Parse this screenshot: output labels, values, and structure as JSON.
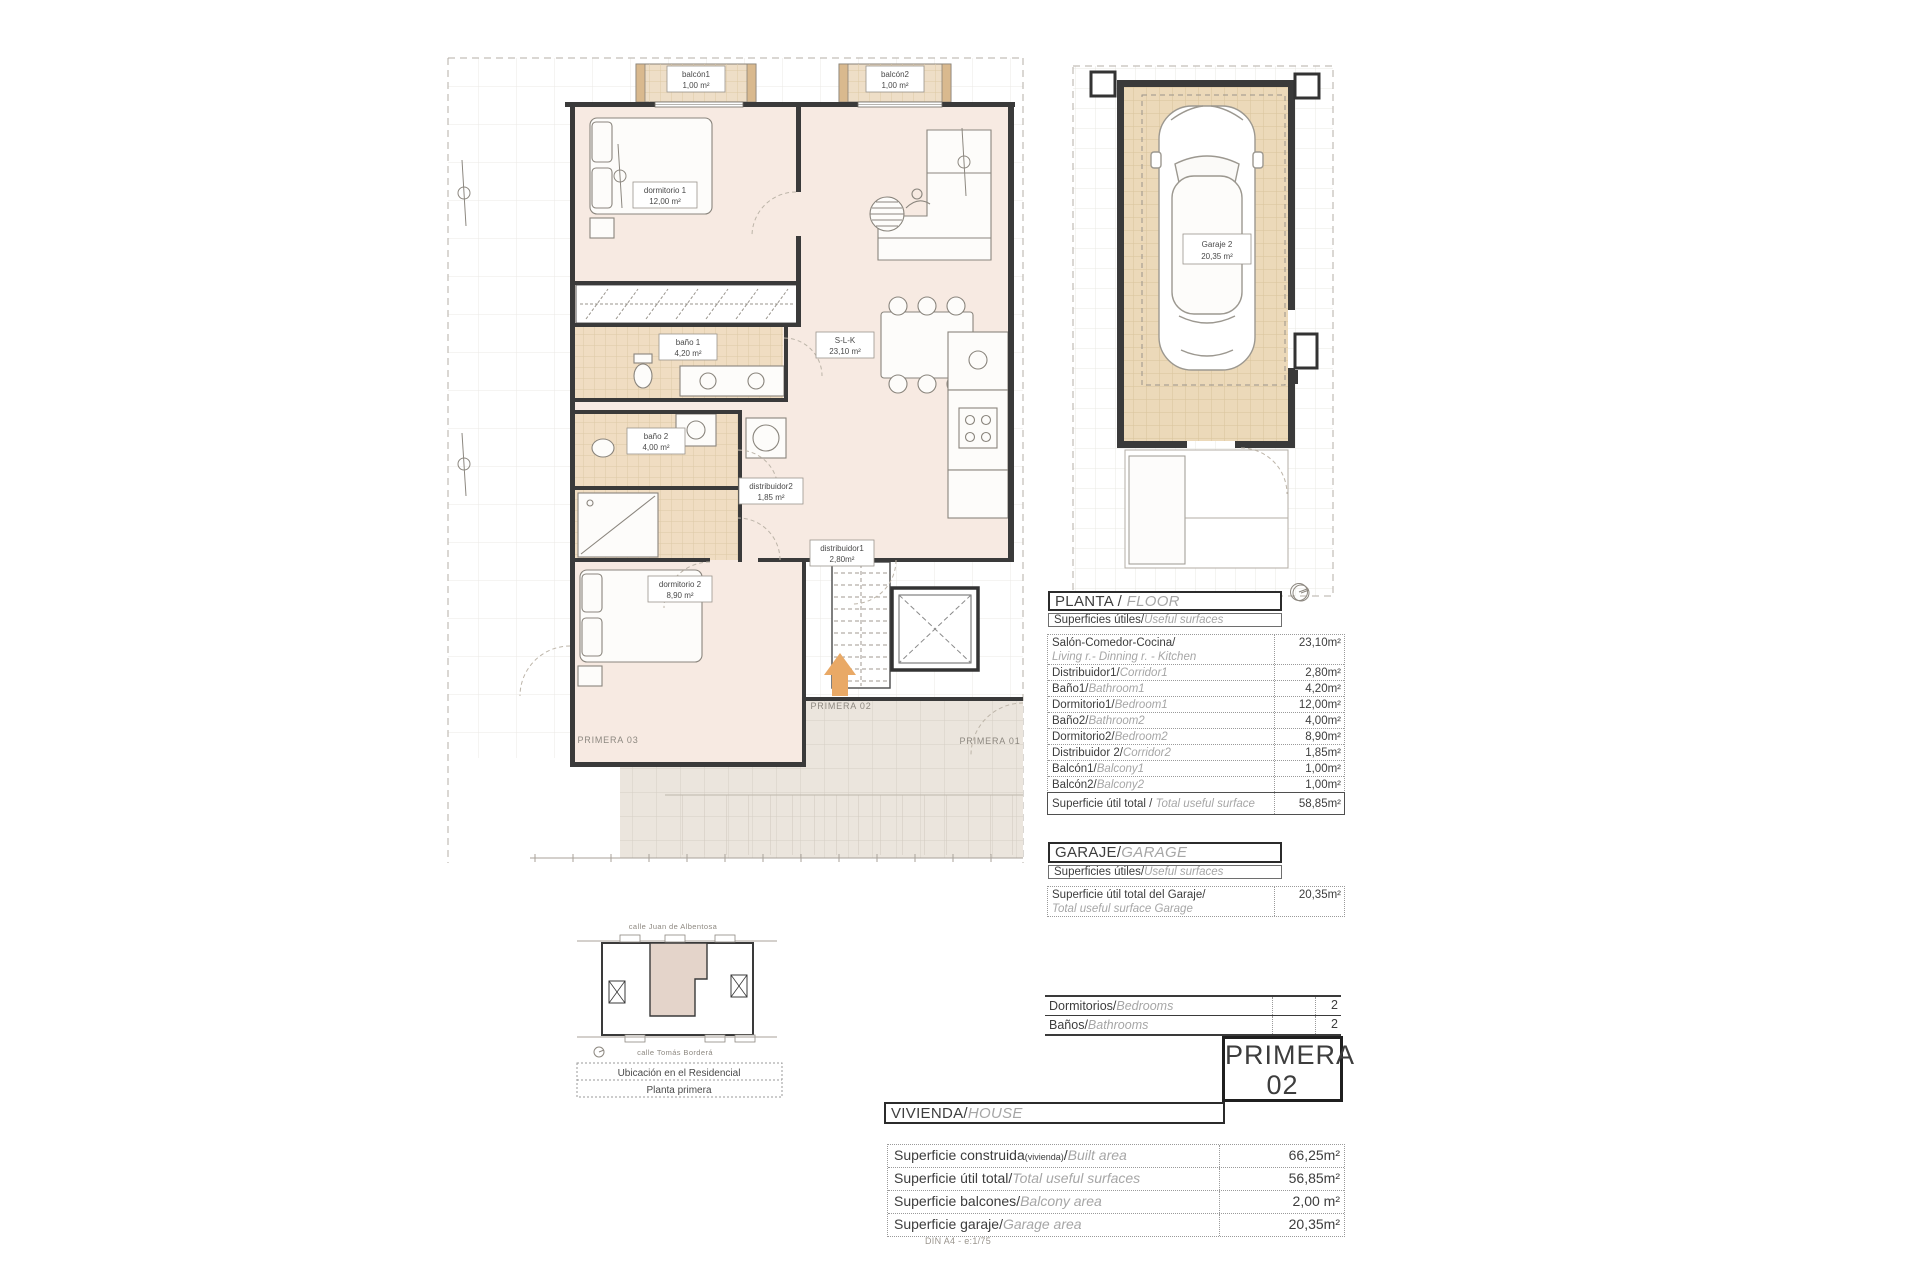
{
  "plan": {
    "rooms": {
      "balcon1": {
        "name": "balcón1",
        "area": "1,00 m²"
      },
      "balcon2": {
        "name": "balcón2",
        "area": "1,00 m²"
      },
      "dorm1": {
        "name": "dormitorio 1",
        "area": "12,00 m²"
      },
      "bano1": {
        "name": "baño 1",
        "area": "4,20 m²"
      },
      "slk": {
        "name": "S-L-K",
        "area": "23,10 m²"
      },
      "bano2": {
        "name": "baño 2",
        "area": "4,00 m²"
      },
      "dist2": {
        "name": "distribuidor2",
        "area": "1,85 m²"
      },
      "dist1": {
        "name": "distribuidor1",
        "area": "2,80m²"
      },
      "dorm2": {
        "name": "dormitorio 2",
        "area": "8,90 m²"
      }
    },
    "units": {
      "left": "PRIMERA 03",
      "current": "PRIMERA 02",
      "right": "PRIMERA 01"
    }
  },
  "garage_plan": {
    "name": "Garaje 2",
    "area": "20,35 m²"
  },
  "site_plan": {
    "street_top": "calle Juan de Albentosa",
    "street_bottom": "calle Tomás Borderá",
    "caption1": "Ubicación en el Residencial",
    "caption2": "Planta primera"
  },
  "floor_section": {
    "title_es": "PLANTA / ",
    "title_en": "FLOOR",
    "subtitle_es": "Superficies útiles/",
    "subtitle_en": "Useful surfaces",
    "rows": [
      {
        "es": "Salón-Comedor-Cocina/",
        "en": "Living r.- Dinning r. - Kitchen",
        "value": "23,10m²"
      },
      {
        "es": "Distribuidor1/",
        "en": "Corridor1",
        "value": "2,80m²"
      },
      {
        "es": "Baño1/",
        "en": "Bathroom1",
        "value": "4,20m²"
      },
      {
        "es": "Dormitorio1/",
        "en": "Bedroom1",
        "value": "12,00m²"
      },
      {
        "es": "Baño2/",
        "en": "Bathroom2",
        "value": "4,00m²"
      },
      {
        "es": "Dormitorio2/",
        "en": "Bedroom2",
        "value": "8,90m²"
      },
      {
        "es": "Distribuidor 2/",
        "en": "Corridor2",
        "value": "1,85m²"
      },
      {
        "es": "Balcón1/",
        "en": "Balcony1",
        "value": "1,00m²"
      },
      {
        "es": "Balcón2/",
        "en": "Balcony2",
        "value": "1,00m²"
      }
    ],
    "total": {
      "es": "Superficie útil total / ",
      "en": "Total useful surface",
      "value": "58,85m²"
    }
  },
  "garage_section": {
    "title_es": "GARAJE/",
    "title_en": "GARAGE",
    "subtitle_es": "Superficies útiles/",
    "subtitle_en": "Useful surfaces",
    "row": {
      "es": "Superficie útil total del Garaje/",
      "en": "Total useful surface Garage",
      "value": "20,35m²"
    }
  },
  "counts": {
    "rows": [
      {
        "es": "Dormitorios/",
        "en": "Bedrooms",
        "value": "2"
      },
      {
        "es": "Baños/",
        "en": "Bathrooms",
        "value": "2"
      }
    ]
  },
  "badge": {
    "line1": "PRIMERA",
    "line2": "02"
  },
  "house_section": {
    "title_es": "VIVIENDA/",
    "title_en": "HOUSE",
    "rows": [
      {
        "es": "Superficie construida",
        "note": "(vivienda)",
        "sep": "/",
        "en": "Built area",
        "value": "66,25m²"
      },
      {
        "es": "Superficie útil total",
        "note": "",
        "sep": "/",
        "en": "Total useful surfaces",
        "value": "56,85m²"
      },
      {
        "es": "Superficie balcones",
        "note": "",
        "sep": "/",
        "en": "Balcony area",
        "value": "2,00 m²"
      },
      {
        "es": "Superficie garaje",
        "note": "",
        "sep": "/",
        "en": "Garage area",
        "value": "20,35m²"
      }
    ]
  },
  "footer_note": "DIN A4 - e:1/75",
  "colors": {
    "accent_arrow": "#e9a966",
    "room_fill": "#f7eae2",
    "tile_fill": "#f0ddc2",
    "garage_floor": "#ecd9b9",
    "terrace_fill": "#ebe5dd",
    "wall": "#3a3a3a"
  }
}
